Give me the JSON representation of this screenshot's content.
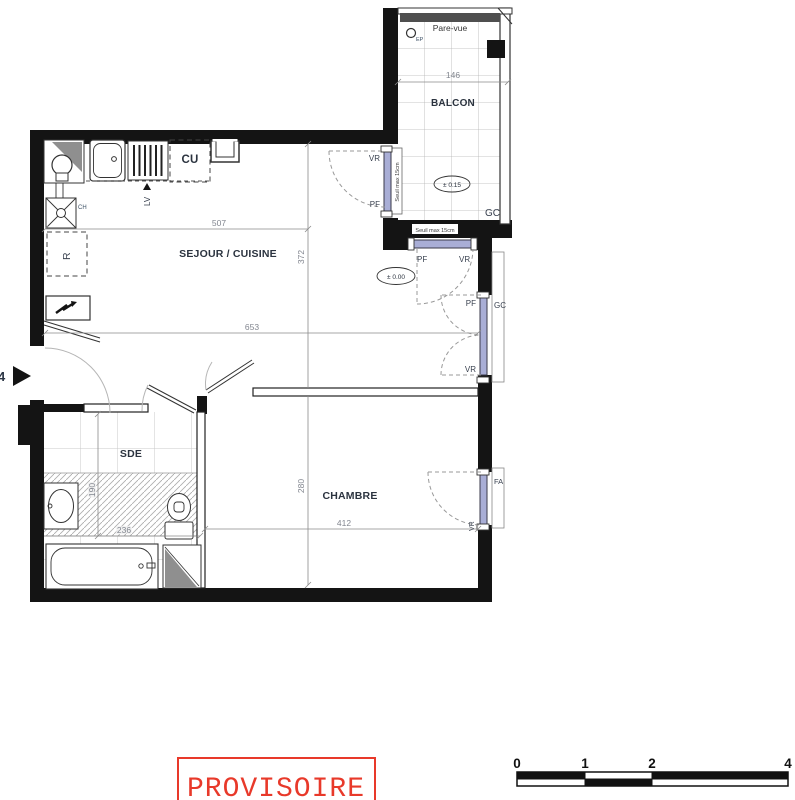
{
  "rooms": {
    "living": "SEJOUR / CUISINE",
    "bedroom": "CHAMBRE",
    "bathroom": "SDE",
    "balcony": "BALCON"
  },
  "dims": {
    "living_width": "507",
    "living_depth": "372",
    "total_width": "653",
    "balcony_width": "146",
    "bedroom_depth": "280",
    "bedroom_width": "412",
    "bathroom_depth": "190",
    "bathroom_width": "236"
  },
  "levels": {
    "balcony": "± 0.15",
    "living": "± 0.00"
  },
  "labels": {
    "vr": "VR",
    "pf": "PF",
    "gc": "GC",
    "fa": "FA",
    "cu": "CU",
    "lv": "LV",
    "fridge": "R",
    "ch": "CH",
    "ep": "EP",
    "pare_vue": "Pare-vue",
    "seuil": "Seuil max 15cm",
    "entrance_no": "4"
  },
  "stamp": {
    "text": "PROVISOIRE",
    "color": "#e8392a"
  },
  "scale_bar": {
    "t0": "0",
    "t1": "1",
    "t2": "2",
    "t4": "4"
  },
  "colors": {
    "wall": "#141414",
    "window": "#a9aed6",
    "stamp_red": "#e8392a"
  }
}
